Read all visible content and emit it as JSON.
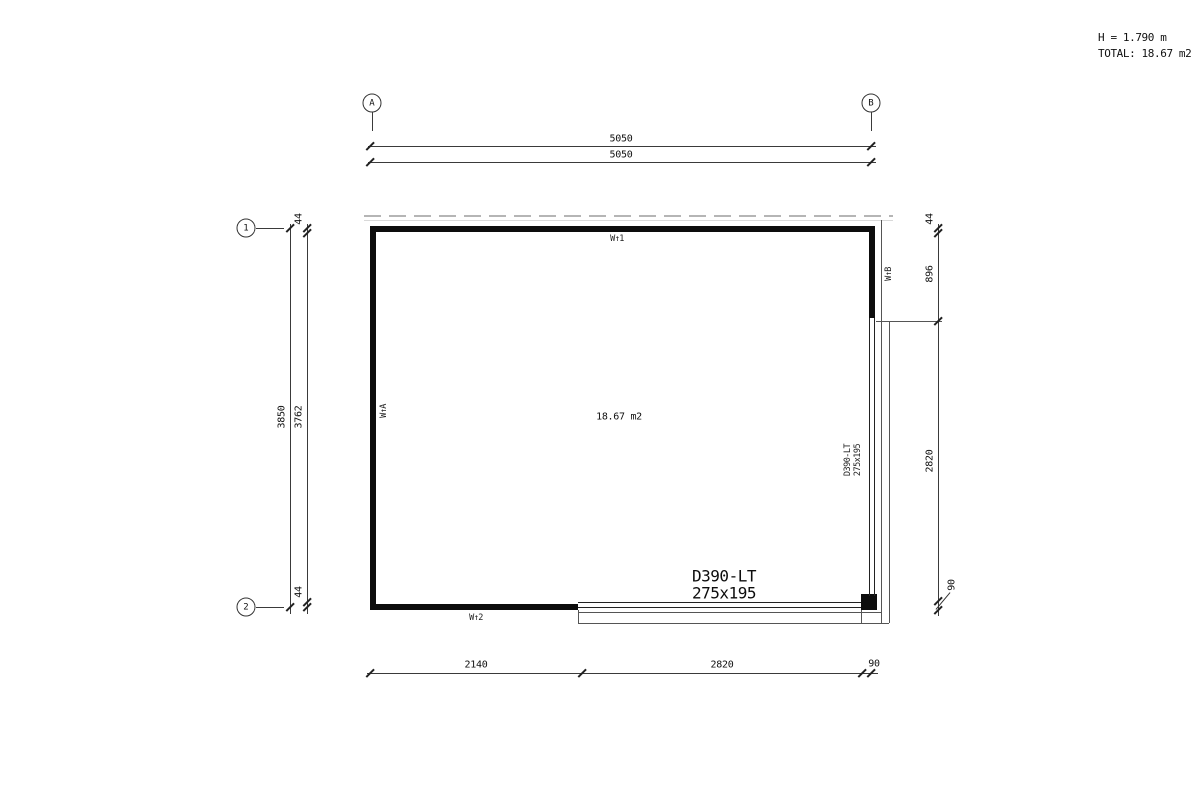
{
  "info": {
    "height": "H = 1.790 m",
    "total": "TOTAL: 18.67 m2"
  },
  "grid": {
    "col_a": "A",
    "col_b": "B",
    "row_1": "1",
    "row_2": "2"
  },
  "dims": {
    "top_outer": "5050",
    "top_inner": "5050",
    "left_total": "3850",
    "left_inner": "3762",
    "left_top": "44",
    "left_bottom": "44",
    "right_top": "44",
    "right_upper": "896",
    "right_door": "2820",
    "right_post": "90",
    "bottom_left": "2140",
    "bottom_door": "2820",
    "bottom_post": "90"
  },
  "walls": {
    "top": "W↑1",
    "left": "W↑A",
    "bottom": "W↑2",
    "right": "W↑B"
  },
  "room": {
    "area": "18.67 m2"
  },
  "door": {
    "model": "D390-LT",
    "size": "275x195",
    "side_model": "D390-LT",
    "side_size": "275x195"
  }
}
